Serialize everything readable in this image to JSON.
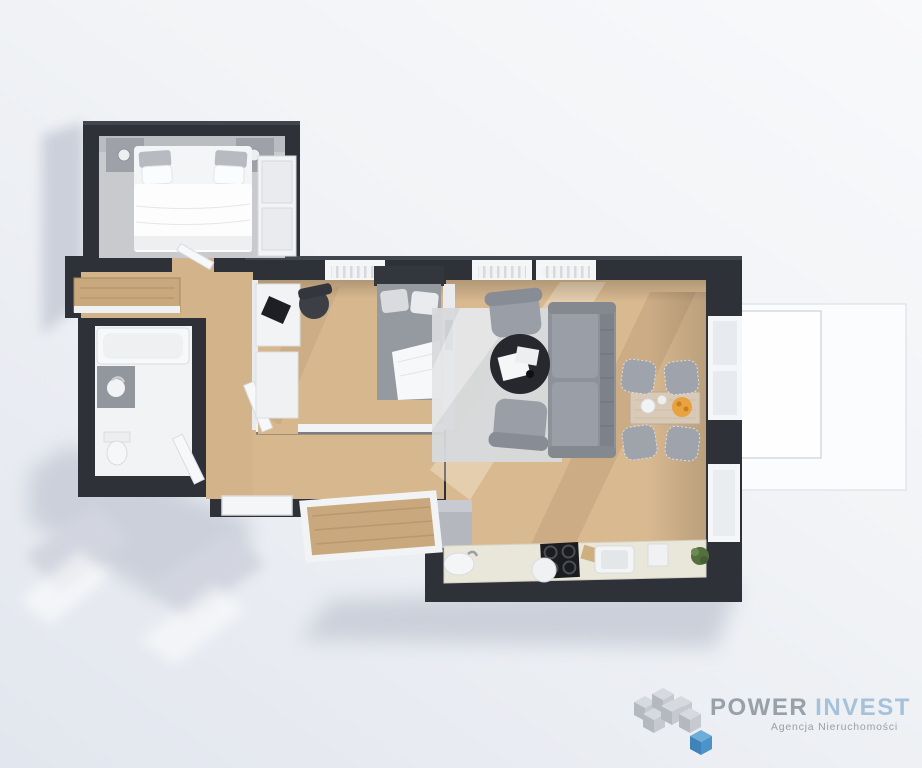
{
  "page": {
    "width": 922,
    "height": 768,
    "background": "#eef0f4"
  },
  "branding": {
    "name_primary": "POWER",
    "name_secondary": "INVEST",
    "tagline": "Agencja Nieruchomości",
    "colors": {
      "primary_text": "#98a0a8",
      "secondary_text": "#a5c2da",
      "tagline_text": "#9aa0a6",
      "cube_gray": "#c3c7cd",
      "cube_blue": "#4b93c9"
    }
  },
  "floorplan": {
    "view": "3D top-down apartment render",
    "palette": {
      "walls": "#2e3138",
      "wood_floor": "#d6b78e",
      "bedroom_carpet": "#c8cacd",
      "bathroom_floor": "#f2f3f5",
      "living_rug": "#d7d9dc",
      "sofa_gray": "#8d9199",
      "kitchen_counter": "#e9e6da",
      "terrace_white": "#fbfcfe",
      "shadow": "#c9cdd8",
      "cooktop_black": "#1a1c20",
      "fruit_orange": "#e8a23f",
      "plant_green": "#55703f"
    },
    "rooms": [
      {
        "id": "bedroom",
        "furniture": [
          "double bed",
          "nightstand left",
          "nightstand right",
          "table lamps",
          "wardrobe",
          "gray carpet"
        ]
      },
      {
        "id": "hallway",
        "furniture": [
          "wooden console cabinet",
          "entrance door"
        ]
      },
      {
        "id": "bathroom",
        "furniture": [
          "bathtub",
          "washbasin counter",
          "toilet",
          "door"
        ]
      },
      {
        "id": "office-bedroom",
        "furniture": [
          "white desk",
          "laptop",
          "office chair",
          "single bed",
          "white cabinet",
          "door"
        ]
      },
      {
        "id": "living-room",
        "furniture": [
          "gray sofa",
          "armchair top",
          "armchair bottom",
          "round black coffee table",
          "light rug",
          "wall tv"
        ]
      },
      {
        "id": "dining-area",
        "furniture": [
          "wooden dining table",
          "four upholstered chairs",
          "fruit bowl",
          "plates"
        ]
      },
      {
        "id": "kitchen",
        "furniture": [
          "fridge cabinet",
          "countertop",
          "left sink",
          "induction cooktop",
          "right sink",
          "plant"
        ]
      },
      {
        "id": "small-balcony",
        "furniture": [
          "wooden deck",
          "white railing"
        ]
      },
      {
        "id": "terrace",
        "furniture": [
          "white terrace floor"
        ]
      }
    ]
  }
}
